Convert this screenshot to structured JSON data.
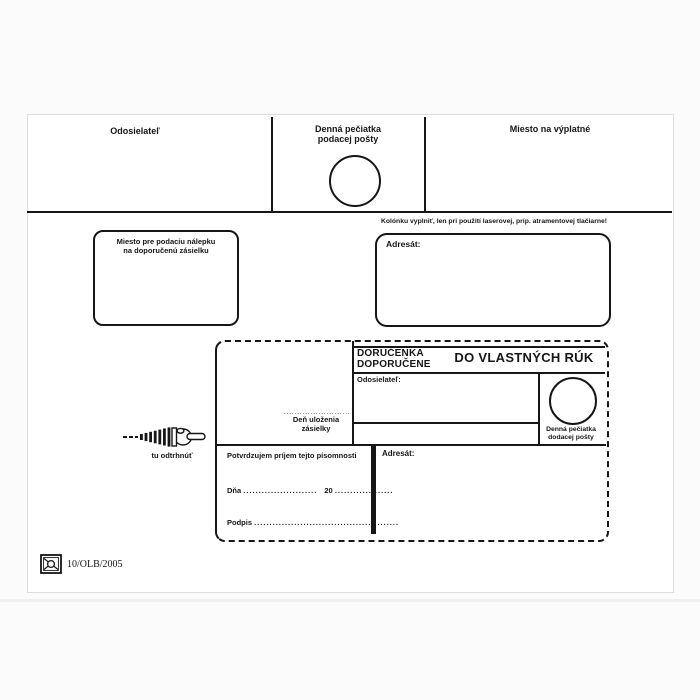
{
  "top_band": {
    "sender_label": "Odosielateľ",
    "origin_stamp_line1": "Denná pečiatka",
    "origin_stamp_line2": "podacej pošty",
    "postage_label": "Miesto na výplatné"
  },
  "middle_band": {
    "sticker_box_line1": "Miesto pre podaciu nálepku",
    "sticker_box_line2": "na doporučenú zásielku",
    "printer_note": "Kolónku vyplniť, len pri použití laserovej, príp. atramentovej tlačiarne!",
    "addressee_label": "Adresát:"
  },
  "slip": {
    "title_line1": "DORUČENKA",
    "title_line2": "DOPORUČENE",
    "title_right": "DO VLASTNÝCH RÚK",
    "sender_label": "Odosielateľ:",
    "deposit_dots": ".........................",
    "deposit_line1": "Deň uloženia",
    "deposit_line2": "zásielky",
    "delivery_stamp_line1": "Denná pečiatka",
    "delivery_stamp_line2": "dodacej pošty",
    "addressee_label": "Adresát:",
    "confirm_text": "Potvrdzujem príjem tejto písomnosti",
    "date_label": "Dňa",
    "date_dots": "........................",
    "year_prefix": "20",
    "year_dots": "...................",
    "signature_label": "Podpis",
    "signature_dots": "..............................................."
  },
  "tear": {
    "label": "tu odtrhnúť"
  },
  "footer": {
    "form_code": "10/OLB/2005"
  },
  "colors": {
    "ink": "#161616",
    "paper": "#ffffff"
  }
}
